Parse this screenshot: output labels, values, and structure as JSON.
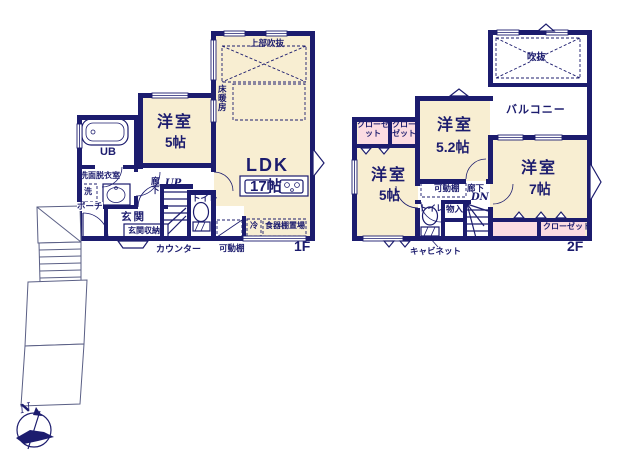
{
  "colors": {
    "wall": "#1c1c6e",
    "room": "#f8eed2",
    "closet": "#fbdce2"
  },
  "f1": {
    "floor": "1F",
    "ldk": "LDK",
    "ldk_size": "17帖",
    "yoshitsu": "洋室",
    "yoshitsu_size": "5帖",
    "joubu_fukinuke": "上部吹抜",
    "yukadanbou": "床暖房",
    "ub": "UB",
    "senmen": "洗面脱衣室",
    "sen": "洗",
    "porch": "ポーチ",
    "genkan": "玄関",
    "genkan_shuno": "玄関収納",
    "rouka": "廊下",
    "up": "UP",
    "toilet": "トイレ",
    "counter": "カウンター",
    "kadodana": "可動棚",
    "rei": "冷",
    "shokkidana": "食器棚置場"
  },
  "f2": {
    "floor": "2F",
    "fukinuke": "吹抜",
    "balcony": "バルコニー",
    "closet_a": "クローゼット",
    "closet_b": "クローゼット",
    "closet_c": "クローゼット",
    "yoshitsu52": "洋室",
    "yoshitsu52_size": "5.2帖",
    "yoshitsu7": "洋室",
    "yoshitsu7_size": "7帖",
    "yoshitsu5": "洋室",
    "yoshitsu5_size": "5帖",
    "kadodana": "可動棚",
    "rouka": "廊下",
    "dn": "DN",
    "toilet": "トイレ",
    "monoire": "物入",
    "cabinet": "キャビネット"
  },
  "compass": {
    "north": "N"
  }
}
